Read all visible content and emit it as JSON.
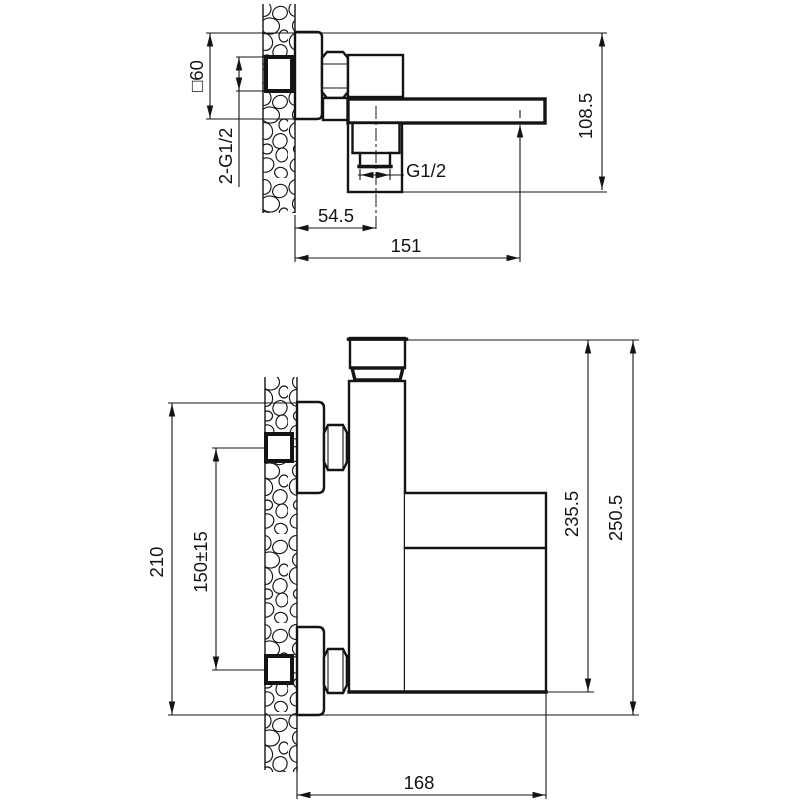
{
  "drawing": {
    "type": "installation-dimension-drawing",
    "line_color": "#141414",
    "background_color": "#ffffff",
    "top_view": {
      "dims": {
        "flange_size": "□60",
        "inlet_thread": "2-G1/2",
        "outlet_thread": "G1/2",
        "outlet_offset": "54.5",
        "spout_reach": "151",
        "overall_height": "108.5"
      }
    },
    "front_view": {
      "dims": {
        "wall_plate_span": "210",
        "inlet_spacing": "150±15",
        "body_height": "235.5",
        "overall_height": "250.5",
        "spout_reach": "168"
      }
    }
  }
}
